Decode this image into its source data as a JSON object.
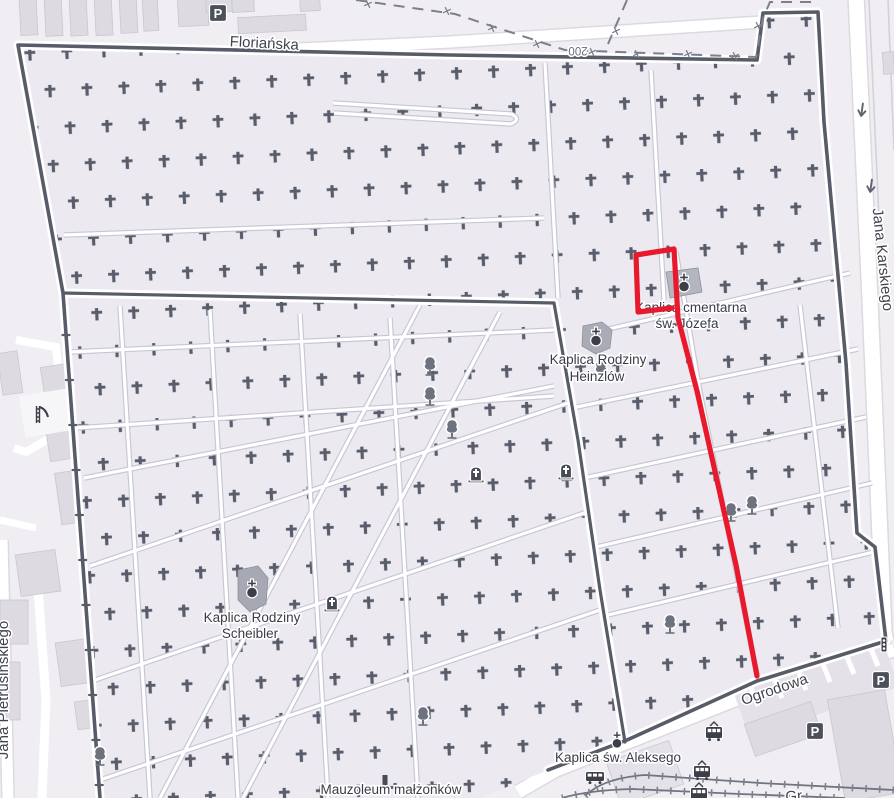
{
  "map_title": "Cemetery map with red navigation route",
  "streets": {
    "florianska": "Floriańska",
    "karskiego": "Jana Karskiego",
    "ogrodowa": "Ogrodowa",
    "pietrusinskiego": "Jana Pietrusińskiego",
    "partial_bottom": "Gr"
  },
  "pois": {
    "jozefa_line1": "Kaplica cmentarna",
    "jozefa_line2": "św. Józefa",
    "heinzlow_line1": "Kaplica Rodziny",
    "heinzlow_line2": "Heinzlów",
    "scheibler_line1": "Kaplica Rodziny",
    "scheibler_line2": "Scheibler",
    "aleksego": "Kaplica św. Aleksego",
    "mauzoleum": "Mauzoleum małżonków"
  },
  "markers": {
    "parking": "P",
    "wall_length": "200"
  },
  "colors": {
    "route": "#e8182d",
    "boundary": "#585c68",
    "cross": "#585c6b",
    "cemetery_fill": "#eceaf0",
    "background": "#f0eef2",
    "building": "#dddbe1",
    "path_casing": "#c6c7d2",
    "label": "#3a3d47"
  }
}
